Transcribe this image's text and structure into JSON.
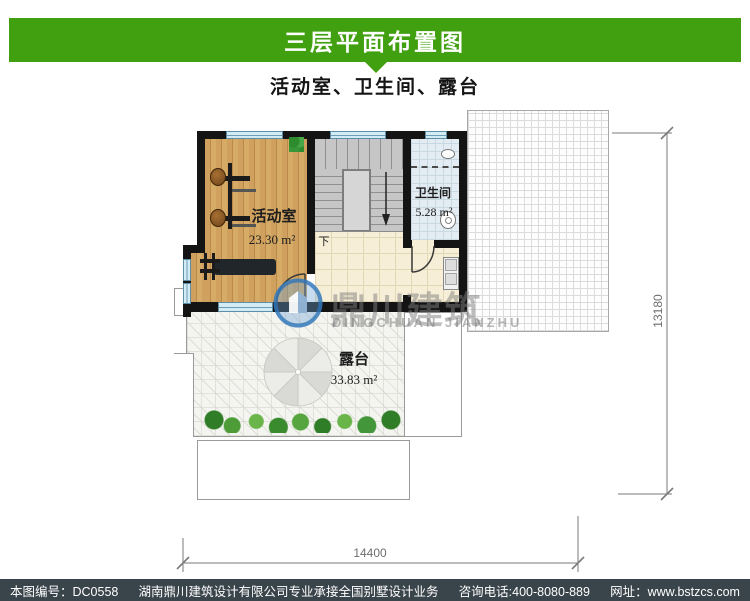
{
  "header": {
    "title": "三层平面布置图",
    "subtitle": "活动室、卫生间、露台"
  },
  "plan": {
    "rooms": [
      {
        "name": "活动室",
        "area": "23.30 m²"
      },
      {
        "name": "卫生间",
        "area": "5.28 m²"
      },
      {
        "name": "露台",
        "area": "33.83 m²"
      }
    ],
    "stair_down_label": "下",
    "dimensions": {
      "bottom": "14400",
      "right": "13180"
    }
  },
  "watermark": {
    "name_cn": "鼎川建筑",
    "name_en": "DINGCHUAN JIANZHU"
  },
  "footer": {
    "drawing_number": "本图编号：DC0558",
    "company": "湖南鼎川建筑设计有限公司专业承接全国别墅设计业务",
    "phone": "咨询电话:400-8080-889",
    "website": "网址：www.bstzcs.com"
  },
  "colors": {
    "banner_green": "#41a010",
    "footer_bg": "#3a444b",
    "wall": "#141414",
    "watermark_blue": "#3279bc"
  }
}
